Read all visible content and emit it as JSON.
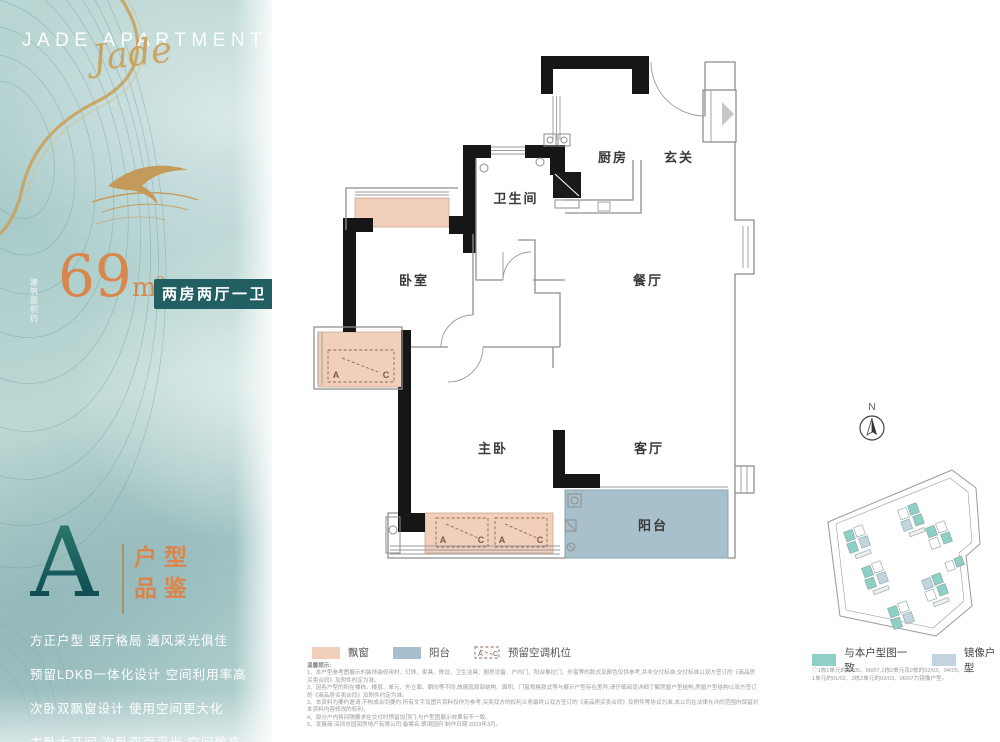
{
  "brand": {
    "title": "JADE APARTMENTS",
    "script_word": "Jade"
  },
  "area": {
    "prefix_top": "建筑",
    "prefix_bottom": "面积约",
    "number": "69",
    "unit": "m",
    "unit_sup": "2",
    "type_tag": "两房两厅一卫"
  },
  "unit": {
    "letter": "A",
    "subtitle_top": "户型",
    "subtitle_bottom": "品鉴",
    "features": [
      "方正户型  竖厅格局  通风采光俱佳",
      "预留LDKB一体化设计 空间利用率高",
      "次卧双飘窗设计   使用空间更大化",
      "主卧大开间 次卧双面采光 空间敞亮"
    ]
  },
  "plan": {
    "rooms": {
      "kitchen": "厨房",
      "foyer": "玄关",
      "bathroom": "卫生间",
      "bedroom": "卧室",
      "dining": "餐厅",
      "master": "主卧",
      "living": "客厅",
      "balcony": "阳台"
    },
    "ac_a": "A",
    "ac_c": "C"
  },
  "legend": {
    "bay_window": "飘窗",
    "balcony": "阳台",
    "ac_space": "预留空调机位"
  },
  "site_map": {
    "compass": "N",
    "same_label": "与本户型图一致",
    "mirror_label": "镜像户型",
    "note_line1": "◇1栋1单元的04/05、06/07,1栋2单元及2栋的02/03、04/05、3栋",
    "note_line2": "1单元的01/02、3栋2单元的02/03、06/07为镜像户型。"
  },
  "notes": {
    "title": "温馨提示:",
    "lines": [
      "1、本户型参考图展示的装饰装修用材、灯饰、家具、陈设、卫生洁具、厨房设备、户内门、阳台推拉门、外窗等的款式及颜色仅供参考,并非交付标准;交付标准以双方签订的《商品房买卖合同》及附件约定为准。",
      "2、因各户型的所在楼栋、楼层、单元、外立面、朝向等不同,故展现局部结构、面积、门窗规格款式等与展示户型存在差异,请仔细阅览详细了解房屋户型结构,房屋户型结构以双方签订的《商品房买卖合同》及附件约定为准。",
      "3、本资料为要约邀请,不构成合同要约,所有文字及图片资料仅作为参考,买卖双方的权利义务最终以双方签订的《商品房买卖合同》及附件等协议为准,本公司在法律允许的范围内保留对本资料内容修改的权利。",
      "4、部分户内将间隔要求在交付时预留加顶门,与户型图展示效果有不一致。",
      "5、发展商:深圳市园润房地产有限公司;备案名:翠璟园府;制作日期:2023年3月。"
    ]
  },
  "colors": {
    "accent_orange": "#d9854b",
    "badge_teal": "#215f63",
    "bay_fill": "#f2cfba",
    "balcony_fill": "#a7c0cb",
    "site_same": "#8ed0c6",
    "site_mirror": "#c2d4de"
  }
}
